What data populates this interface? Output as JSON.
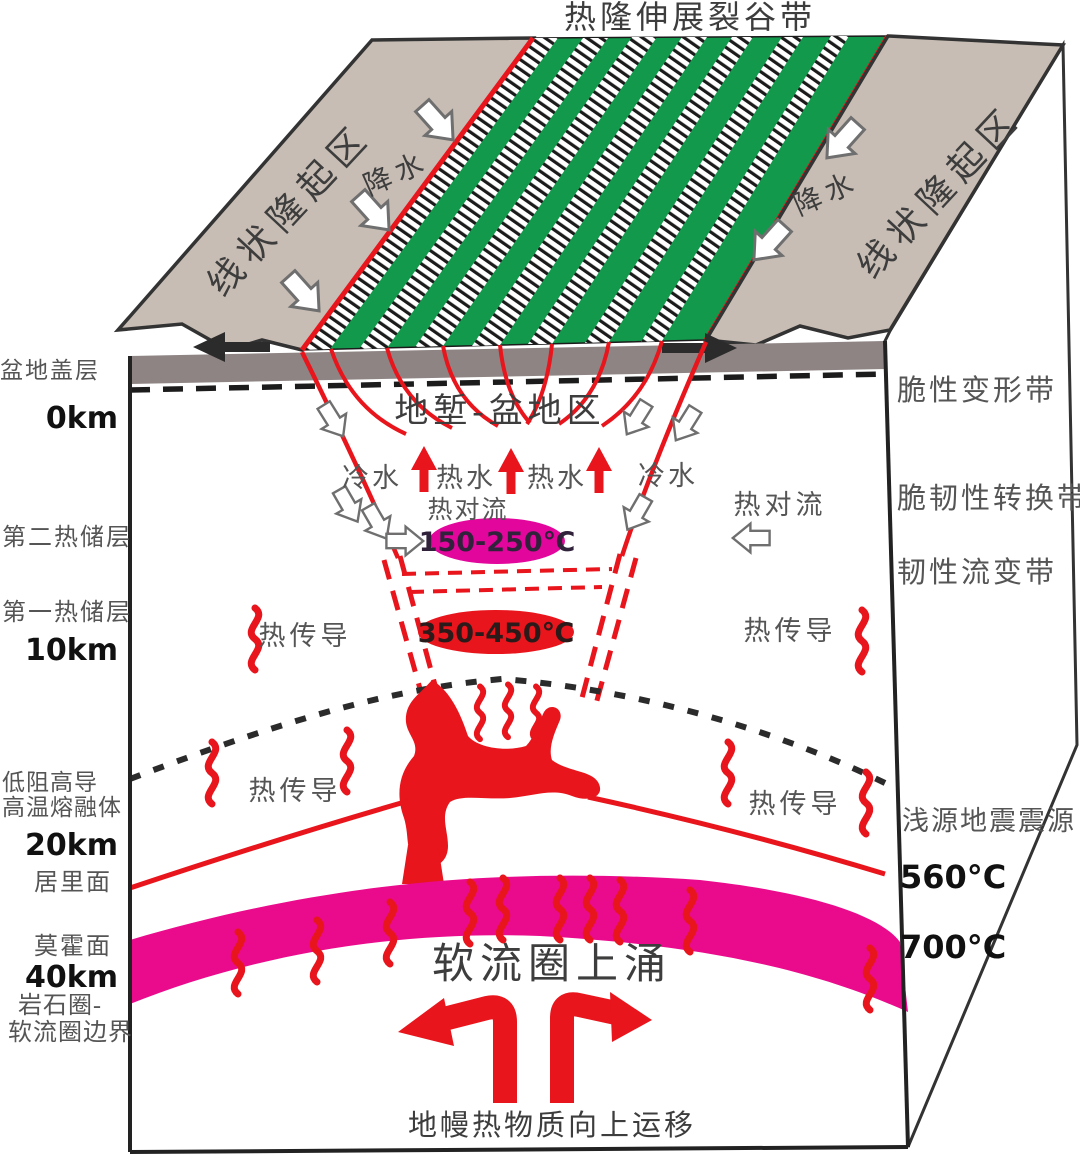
{
  "title": "热隆伸展裂谷带",
  "colors": {
    "slope_gray": "#c7bdb4",
    "cap_gray": "#8d8483",
    "rift_green": "#12994c",
    "fault_red": "#e8151c",
    "moho_magenta": "#ea0b8c",
    "ellipse_hot": "#e2069c",
    "label_gray": "#555555",
    "label_dark": "#3d3d3d"
  },
  "top_face": {
    "left_uplift": "线状隆起区",
    "right_uplift": "线状隆起区",
    "left_precip": "降水",
    "right_precip": "降水"
  },
  "left_labels": {
    "basin_cap": "盆地盖层",
    "km0": "0km",
    "reservoir2": "第二热储层",
    "reservoir1": "第一热储层",
    "km10": "10km",
    "low_res_line1": "低阻高导",
    "low_res_line2": "高温熔融体",
    "km20": "20km",
    "curie_surface": "居里面",
    "moho_surface": "莫霍面",
    "km40": "40km",
    "boundary_line1": "岩石圈-",
    "boundary_line2": "软流圈边界"
  },
  "right_labels": {
    "brittle_zone": "脆性变形带",
    "transition_zone": "脆韧性转换带",
    "ductile_zone": "韧性流变带",
    "seismic_source": "浅源地震震源",
    "temp560": "560°C",
    "temp700": "700°C"
  },
  "graben": {
    "title": "地堑-盆地区",
    "cold_left": "冷水",
    "hot_water1": "热水",
    "hot_water2": "热水",
    "cold_right": "冷水",
    "convection_center": "热对流",
    "convection_right": "热对流",
    "ellipse_temp1": "150-250℃",
    "ellipse_temp2": "350-450℃",
    "conduction_upper_left": "热传导",
    "conduction_upper_right": "热传导",
    "conduction_lower_left": "热传导",
    "conduction_lower_right": "热传导"
  },
  "bottom": {
    "upwelling": "软流圈上涌",
    "mantle_transfer": "地幔热物质向上运移"
  }
}
